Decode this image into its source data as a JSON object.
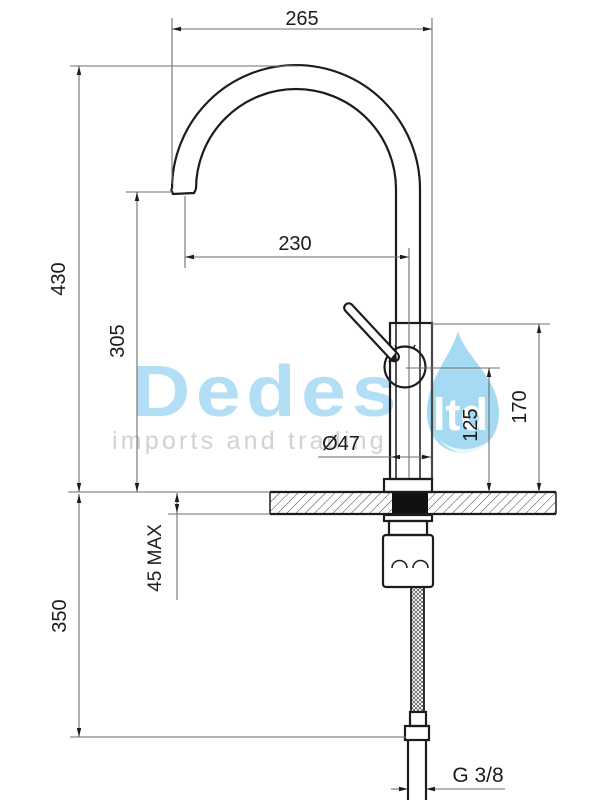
{
  "drawing": {
    "title": "kitchen mixer tap installation drawing",
    "dimensions": {
      "overall_reach": "265",
      "overall_height": "430",
      "outlet_reach": "230",
      "outlet_height": "305",
      "body_height": "170",
      "handle_pivot_height": "125",
      "body_diameter": "Ø47",
      "counter_thickness": "45 MAX",
      "hose_length": "350",
      "thread": "G 3/8"
    },
    "watermark": {
      "brand": "Dedes",
      "suffix": "ltd",
      "tagline": "imports and trading",
      "blue": "#a9dcf4",
      "gray": "#d2d2d2"
    },
    "colors": {
      "object_line": "#1c1c1c",
      "dimension_line": "#6e6e6e",
      "seal": "#111111",
      "background": "#ffffff"
    }
  }
}
